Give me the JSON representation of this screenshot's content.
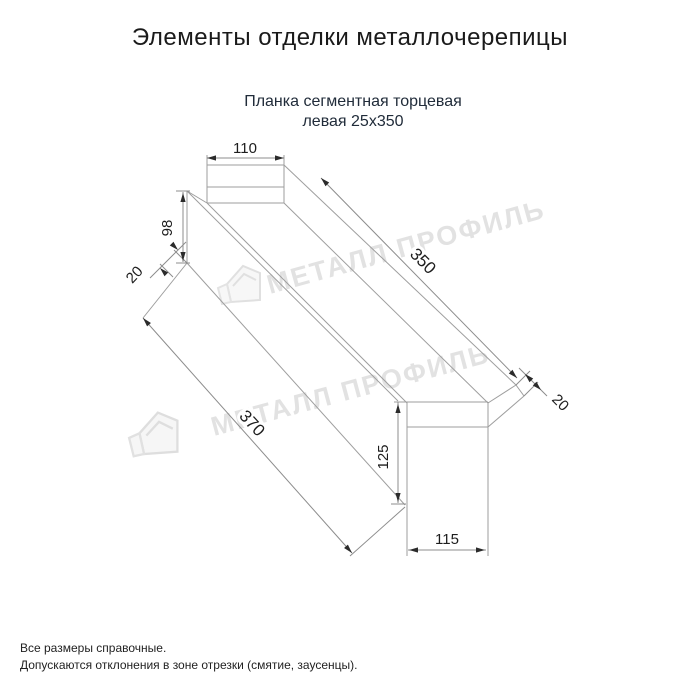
{
  "page": {
    "title": "Элементы отделки металлочерепицы",
    "subtitle_line1": "Планка сегментная торцевая",
    "subtitle_line2": "левая 25х350"
  },
  "watermark": {
    "text": "МЕТАЛЛ ПРОФИЛЬ",
    "logo_name": "metall-profil-house-logo"
  },
  "drawing": {
    "type": "technical-dimension-drawing",
    "dimensions": {
      "top_flange_width": "110",
      "side_height": "98",
      "left_fold": "20",
      "length_top": "350",
      "length_bottom": "370",
      "right_fold": "20",
      "end_face_height": "125",
      "end_face_width": "115"
    }
  },
  "notes": {
    "line1": "Все размеры справочные.",
    "line2": "Допускаются отклонения в зоне отрезки (смятие, заусенцы)."
  },
  "colors": {
    "line_gray": "#9e9e9e",
    "dim_gray": "#8c8c8c",
    "arrow_dark": "#2b2b2b",
    "text_dark": "#1d1d1d",
    "watermark_gray": "#e2e2e2",
    "subtitle_navy": "#212c3a"
  }
}
